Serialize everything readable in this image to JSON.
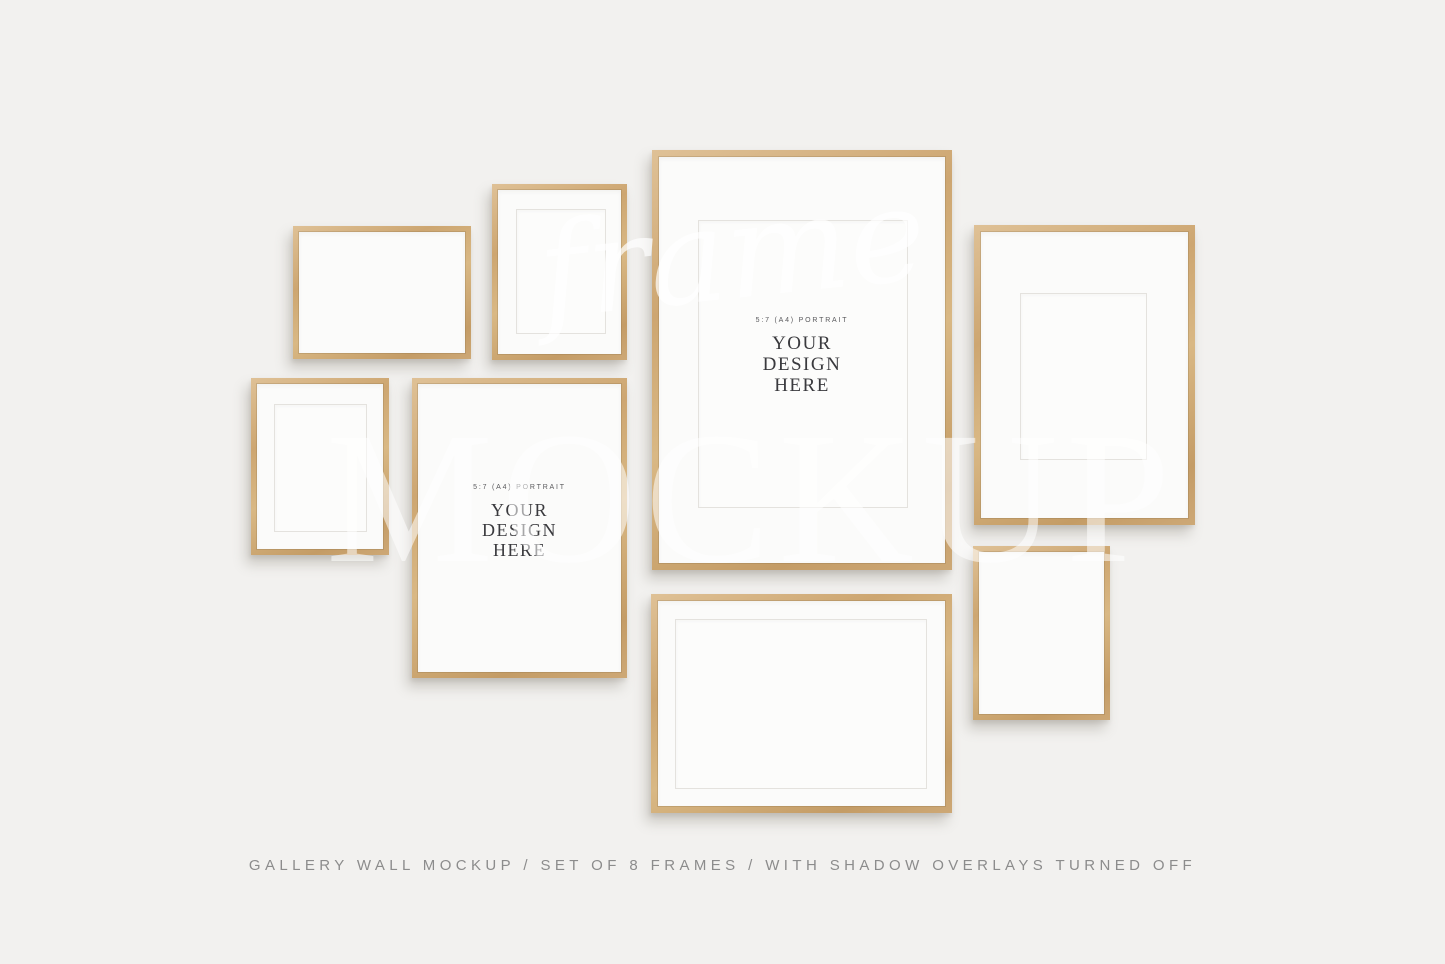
{
  "wall": {
    "background_color": "#f2f1ef"
  },
  "watermark": {
    "script_text": "frame",
    "block_text": "MOCKUP",
    "color": "#ffffff"
  },
  "placeholder": {
    "label": "5:7 (A4) PORTRAIT",
    "lines": [
      "YOUR",
      "DESIGN",
      "HERE"
    ]
  },
  "caption": {
    "text": "GALLERY WALL MOCKUP / SET OF 8 FRAMES / WITH SHADOW OVERLAYS TURNED OFF"
  },
  "frames": [
    {
      "id": "frame-1",
      "orientation": "landscape",
      "mat": false,
      "placeholder_text": false
    },
    {
      "id": "frame-2",
      "orientation": "portrait",
      "mat": true,
      "placeholder_text": false
    },
    {
      "id": "frame-3",
      "orientation": "portrait",
      "mat": true,
      "placeholder_text": false
    },
    {
      "id": "frame-4",
      "orientation": "portrait",
      "mat": false,
      "placeholder_text": true
    },
    {
      "id": "frame-5",
      "orientation": "portrait",
      "mat": true,
      "placeholder_text": true
    },
    {
      "id": "frame-6",
      "orientation": "landscape",
      "mat": true,
      "placeholder_text": false
    },
    {
      "id": "frame-7",
      "orientation": "portrait",
      "mat": true,
      "placeholder_text": false
    },
    {
      "id": "frame-8",
      "orientation": "portrait",
      "mat": false,
      "placeholder_text": false
    }
  ],
  "colors": {
    "wood": "#cfa877",
    "paper": "#fbfbfa",
    "mat_line": "#e4e2de",
    "design_text": "#3a3a3e",
    "label_text": "#59595c",
    "caption_text": "#8c8c8c"
  }
}
